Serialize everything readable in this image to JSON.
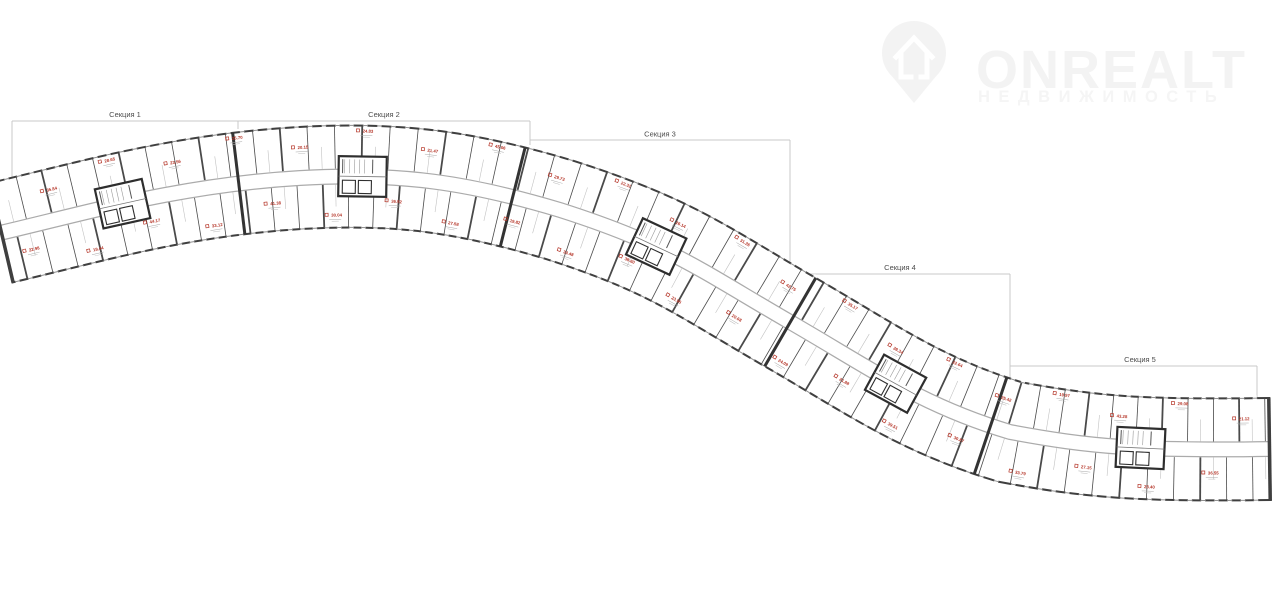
{
  "logo": {
    "brand": "ONREALT",
    "tagline": "НЕДВИЖИМОСТЬ"
  },
  "sections": [
    {
      "label": "Секция 1"
    },
    {
      "label": "Секция 2"
    },
    {
      "label": "Секция 3"
    },
    {
      "label": "Секция 4"
    },
    {
      "label": "Секция 5"
    }
  ],
  "plan": {
    "unit_area_labels": [
      "22.98",
      "35.84",
      "19.44",
      "28.65",
      "44.17",
      "23.56",
      "33.12",
      "25.70",
      "41.38",
      "20.15",
      "30.04",
      "24.83",
      "36.92",
      "21.47",
      "27.58",
      "45.06",
      "19.82",
      "29.73",
      "34.48",
      "22.31",
      "38.60",
      "26.14",
      "23.95",
      "31.26",
      "20.68",
      "42.75",
      "24.09",
      "35.17",
      "21.88",
      "28.34",
      "39.51",
      "22.64",
      "30.87",
      "25.42",
      "33.79",
      "19.97",
      "27.15",
      "43.28",
      "23.40",
      "29.08",
      "36.55",
      "21.12"
    ]
  },
  "colors": {
    "wall": "#3f3f3f",
    "partition": "#4a4a4a",
    "light_line": "#c2c2c2",
    "corridor_edge": "#ababab",
    "accent_red": "#b43326",
    "bracket": "#c9c9c9",
    "logo_gray": "#f3f3f3",
    "background": "#ffffff"
  }
}
